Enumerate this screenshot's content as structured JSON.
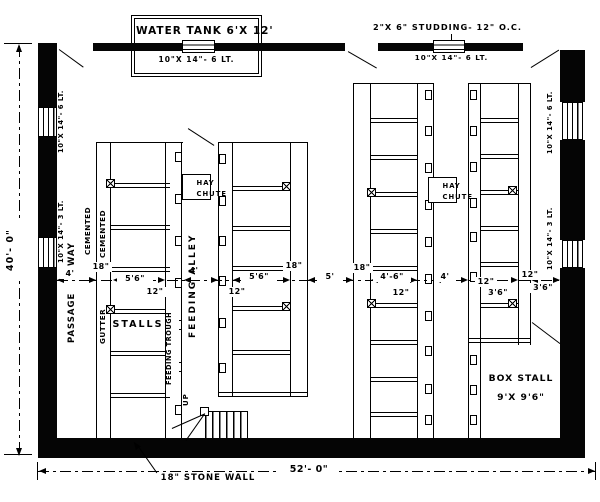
{
  "drawing": {
    "water_tank": "WATER TANK 6'X 12'",
    "water_tank_window": "10\"X 14\"- 6 LT.",
    "studding_note": "2\"X 6\" STUDDING- 12\" O.C.",
    "top_right_window": "10\"X 14\"- 6 LT.",
    "stone_wall_note": "18\" STONE WALL"
  },
  "windows": {
    "left_top": "10\"X 14\"- 6 LT.",
    "left_bottom": "10\"X 14\"- 3 LT.",
    "right_top": "10\"X 14\"- 6 LT.",
    "right_bottom": "10\"X 14\"- 3 LT."
  },
  "rooms": {
    "passage": "PASSAGE",
    "way": "WAY",
    "cemented_left": "CEMENTED",
    "cemented_right": "CEMENTED",
    "gutter": "GUTTER",
    "stalls": "STALLS",
    "feeding_alley": "FEEDING ALLEY",
    "feeding_trough": "FEEDING TROUGH",
    "hay": "HAY",
    "chute": "CHUTE",
    "box_stall": "BOX STALL",
    "box_stall_size": "9'X 9'6\"",
    "up": "UP"
  },
  "dims": {
    "overall_width": "52'- 0\"",
    "overall_height": "40'- 0\"",
    "mid": [
      "4'",
      "18\"",
      "5'6\"",
      "12\"",
      "4'",
      "5'6\"",
      "12\"",
      "18\"",
      "5'",
      "18\"",
      "4'-6\"",
      "12\"",
      "4'",
      "12\"",
      "3'6\"",
      "12\"",
      "3'6\""
    ]
  }
}
